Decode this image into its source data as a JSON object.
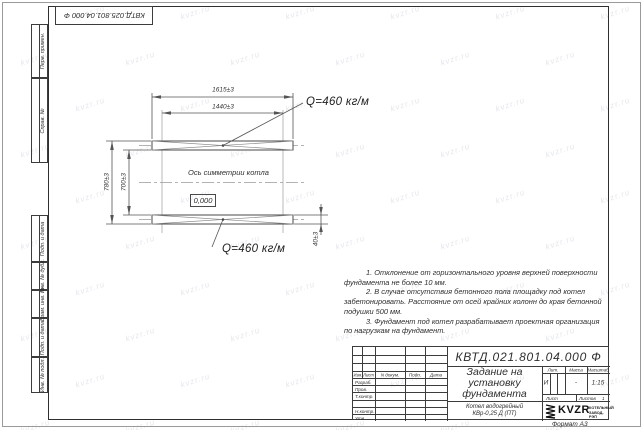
{
  "sheet": {
    "format_label": "Формат А3",
    "watermark_text": "kvzr.ru"
  },
  "top_stamp": {
    "doc_number": "КВТД.025.801.04.000 Ф"
  },
  "left_margin": {
    "boxes": [
      {
        "label": "Перв. примен."
      },
      {
        "label": "Справ. №"
      },
      {
        "label": "Подп. и дата"
      },
      {
        "label": "Инв. № дубл."
      },
      {
        "label": "Взам. инв. №"
      },
      {
        "label": "Подп. и дата"
      },
      {
        "label": "Инв. № подл."
      }
    ]
  },
  "drawing": {
    "dims": {
      "outer_width": "1615±3",
      "inner_width": "1440±3",
      "outer_height": "780±3",
      "inner_height": "700±3",
      "beam_height": "40±3"
    },
    "labels": {
      "load_top": "Q=460 кг/м",
      "load_bottom": "Q=460 кг/м",
      "axis": "Ось симметрии котла",
      "elevation": "0,000"
    }
  },
  "notes": {
    "lines": [
      "1. Отклонение от горизонтального уровня верхней поверхности фундамента не более 10 мм.",
      "2. В случае отсутствия бетонного пола площадку под котел забетонировать. Расстояние от осей крайних колонн до края бетонной подушки 500 мм.",
      "3. Фундамент под котел разрабатывает проектная организация по нагрузкам на фундамент."
    ]
  },
  "title_block": {
    "doc_number": "КВТД.021.801.04.000 Ф",
    "title": "Задание на установку фундамента",
    "product": "Котел водогрейный КВр-0,25 Д (ПТ)",
    "header": {
      "izm": "Изм.",
      "list": "Лист",
      "doc": "N докум.",
      "sign": "Подп.",
      "date": "Дата"
    },
    "roles": [
      "Разраб.",
      "Пров.",
      "Т.контр.",
      "",
      "Н.контр.",
      "Утв."
    ],
    "lit_header": "Лит.",
    "mass_header": "Масса",
    "scale_header": "Масштаб",
    "lit_value": "И",
    "mass_value": "-",
    "scale_value": "1:15",
    "sheet_label": "Лист",
    "sheets_label": "Листов",
    "sheets_value": "1",
    "company": {
      "logo_text": "KVZR",
      "tagline_line1": "КОТЕЛЬНЫЙ",
      "tagline_line2": "ЗАВОД-РЭП"
    }
  }
}
